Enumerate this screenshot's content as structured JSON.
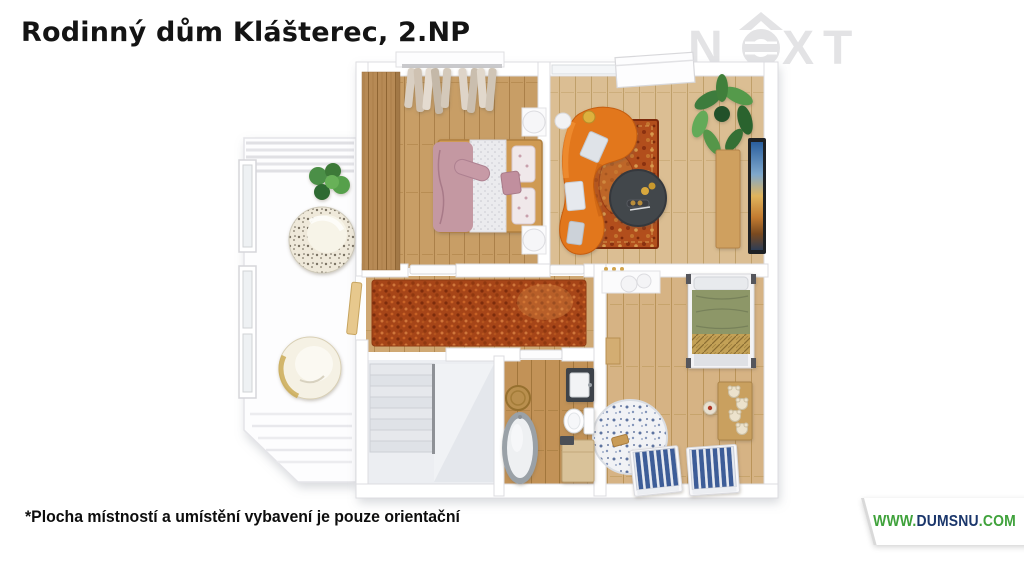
{
  "title": "Rodinný dům Klášterec, 2.NP",
  "footnote": "*Plocha místností a umístění vybavení je pouze orientační",
  "watermark": {
    "brand": "NeXT",
    "letter_n": "N",
    "letters_xt": "XT",
    "color": "#e3e3e5"
  },
  "footer_logo": {
    "www": "WWW.",
    "name": "DUMSNU",
    "tld": ".COM",
    "green": "#3fa23b",
    "navy": "#1a366b"
  },
  "floorplan": {
    "view": "3D top-down render of second floor (2.NP)",
    "rooms": [
      {
        "name": "bedroom",
        "floor_material": "wood",
        "furniture": [
          "wardrobe",
          "hanging-clothes-rack",
          "double-bed",
          "pink-blanket",
          "nightstand",
          "nightstand"
        ]
      },
      {
        "name": "living-room",
        "floor_material": "wood",
        "furniture": [
          "curved-orange-sofa",
          "oriental-rug",
          "round-coffee-table",
          "side-table",
          "table-lamp",
          "potted-plant",
          "tv-sideboard",
          "wall-tv",
          "skylight-window"
        ]
      },
      {
        "name": "hallway",
        "floor_material": "wood",
        "furniture": [
          "red-shag-carpet",
          "balcony-door",
          "wall-hooks"
        ]
      },
      {
        "name": "kids-room",
        "floor_material": "wood",
        "furniture": [
          "white-desk",
          "two-stools",
          "green-single-bed",
          "toy-bench-with-teddy-bears",
          "plush-toy",
          "round-play-rug",
          "kids-bed-blue",
          "kids-bed-blue"
        ]
      },
      {
        "name": "bathroom",
        "floor_material": "wood",
        "furniture": [
          "freestanding-bathtub",
          "sink-vanity",
          "toilet",
          "laundry-cabinet",
          "round-jute-rug"
        ]
      },
      {
        "name": "staircase",
        "floor_material": "concrete",
        "furniture": [
          "u-shaped-stairs",
          "railing",
          "landing"
        ]
      },
      {
        "name": "balcony",
        "floor_material": "white-decking",
        "furniture": [
          "round-lounge-chair",
          "round-lounge-chair",
          "potted-plant",
          "windows",
          "pergola-slats"
        ]
      }
    ],
    "colors": {
      "walls": "#ffffff",
      "wood_light": "#dbbe93",
      "wood_mid": "#c89e66",
      "wood_dark": "#b78a55",
      "sofa_orange": "#e2771d",
      "hall_carpet_red": "#a64518",
      "living_rug_red": "#b24e1c",
      "blanket_pink": "#c498a2",
      "blanket_green": "#8d9768",
      "kids_bed_blue": "#3c5d98",
      "stairs_gray": "#eceef2"
    }
  }
}
